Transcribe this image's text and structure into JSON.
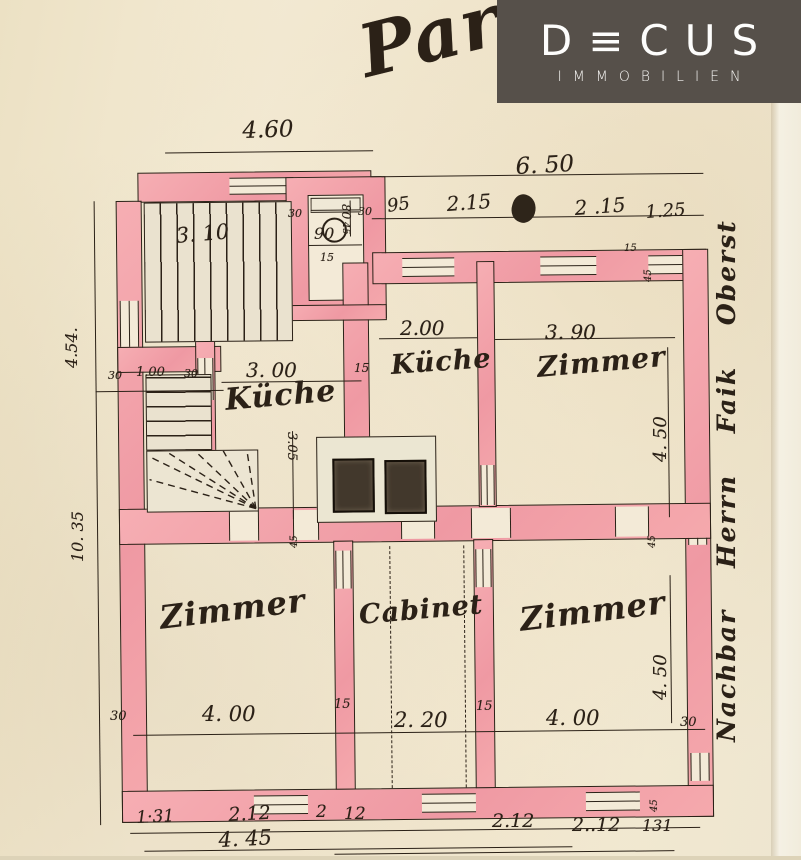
{
  "logo": {
    "brand": "DECUS",
    "wordmark": "D≡CUS",
    "subtitle": "IMMOBILIEN",
    "bg_color": "#56504a",
    "text_color": "#fdfdfc"
  },
  "plan": {
    "title_script": "Par",
    "side_note": "Nachbar Herrn Faik Oberst",
    "room_labels": [
      "Küche",
      "Küche",
      "Zimmer",
      "Zimmer",
      "Cabinet",
      "Zimmer"
    ],
    "colors": {
      "paper": "#f3e9d1",
      "wall_pink": "#f2a2a8",
      "ink": "#2b2117",
      "stove": "#42382c"
    },
    "annotations": [
      {
        "name": "plan-title",
        "text": "Par",
        "x": 352,
        "y": 18,
        "fs": 72,
        "rot": -14,
        "cls": "script title"
      },
      {
        "name": "dim-label",
        "text": "4.60",
        "x": 242,
        "y": 120,
        "fs": 23,
        "rot": -2
      },
      {
        "name": "dim-label",
        "text": "6. 50",
        "x": 515,
        "y": 156,
        "fs": 23,
        "rot": -3
      },
      {
        "name": "dim-label",
        "text": "95",
        "x": 386,
        "y": 198,
        "fs": 18,
        "rot": -8
      },
      {
        "name": "dim-label",
        "text": "2.15",
        "x": 446,
        "y": 194,
        "fs": 20,
        "rot": -4
      },
      {
        "name": "dim-label",
        "text": "2 .15",
        "x": 574,
        "y": 198,
        "fs": 20,
        "rot": -4
      },
      {
        "name": "dim-label",
        "text": "1.25",
        "x": 645,
        "y": 204,
        "fs": 18,
        "rot": -4
      },
      {
        "name": "dim-label",
        "text": "3. 10",
        "x": 175,
        "y": 226,
        "fs": 21,
        "rot": -5
      },
      {
        "name": "dim-label",
        "text": "80",
        "x": 352,
        "y": 204,
        "fs": 12,
        "rot": 90
      },
      {
        "name": "dim-label",
        "text": "30",
        "x": 288,
        "y": 208,
        "fs": 11
      },
      {
        "name": "dim-label",
        "text": "30",
        "x": 358,
        "y": 206,
        "fs": 11
      },
      {
        "name": "dim-label",
        "text": "90",
        "x": 314,
        "y": 226,
        "fs": 16
      },
      {
        "name": "dim-label",
        "text": "45",
        "x": 350,
        "y": 222,
        "fs": 10,
        "rot": 90
      },
      {
        "name": "dim-label",
        "text": "15",
        "x": 320,
        "y": 252,
        "fs": 11
      },
      {
        "name": "dim-label",
        "text": "4.54.",
        "x": 64,
        "y": 368,
        "fs": 16,
        "rot": -90
      },
      {
        "name": "dim-label",
        "text": "10. 35",
        "x": 70,
        "y": 562,
        "fs": 16,
        "rot": -90
      },
      {
        "name": "dim-label",
        "text": "30",
        "x": 108,
        "y": 370,
        "fs": 11
      },
      {
        "name": "dim-label",
        "text": "1.00",
        "x": 136,
        "y": 366,
        "fs": 13
      },
      {
        "name": "dim-label",
        "text": "30",
        "x": 184,
        "y": 368,
        "fs": 11
      },
      {
        "name": "dim-label",
        "text": "3. 00",
        "x": 246,
        "y": 360,
        "fs": 20
      },
      {
        "name": "dim-label",
        "text": "15",
        "x": 354,
        "y": 362,
        "fs": 12
      },
      {
        "name": "dim-label",
        "text": "2.00",
        "x": 400,
        "y": 318,
        "fs": 20
      },
      {
        "name": "dim-label",
        "text": "3. 90",
        "x": 545,
        "y": 322,
        "fs": 20
      },
      {
        "name": "dim-label",
        "text": "15",
        "x": 624,
        "y": 244,
        "fs": 10
      },
      {
        "name": "dim-label",
        "text": "45",
        "x": 644,
        "y": 282,
        "fs": 10,
        "rot": -90
      },
      {
        "name": "dim-label",
        "text": "4. 50",
        "x": 652,
        "y": 462,
        "fs": 18,
        "rot": -90
      },
      {
        "name": "dim-label",
        "text": "45",
        "x": 648,
        "y": 548,
        "fs": 10,
        "rot": -90
      },
      {
        "name": "dim-label",
        "text": "3.05",
        "x": 298,
        "y": 432,
        "fs": 13,
        "rot": 90
      },
      {
        "name": "dim-label",
        "text": "45",
        "x": 290,
        "y": 548,
        "fs": 10,
        "rot": -90
      },
      {
        "name": "room-label",
        "text": "Küche",
        "x": 224,
        "y": 386,
        "fs": 30,
        "rot": -5,
        "cls": "script"
      },
      {
        "name": "room-label",
        "text": "Küche",
        "x": 390,
        "y": 352,
        "fs": 27,
        "rot": -4,
        "cls": "script"
      },
      {
        "name": "room-label",
        "text": "Zimmer",
        "x": 536,
        "y": 354,
        "fs": 28,
        "rot": -5,
        "cls": "script"
      },
      {
        "name": "room-label",
        "text": "Zimmer",
        "x": 158,
        "y": 602,
        "fs": 32,
        "rot": -7,
        "cls": "script"
      },
      {
        "name": "room-label",
        "text": "Cabinet",
        "x": 358,
        "y": 602,
        "fs": 27,
        "rot": -5,
        "cls": "script"
      },
      {
        "name": "room-label",
        "text": "Zimmer",
        "x": 518,
        "y": 604,
        "fs": 32,
        "rot": -7,
        "cls": "script"
      },
      {
        "name": "dim-label",
        "text": "30",
        "x": 110,
        "y": 710,
        "fs": 13
      },
      {
        "name": "dim-label",
        "text": "4. 00",
        "x": 202,
        "y": 704,
        "fs": 21
      },
      {
        "name": "dim-label",
        "text": "15",
        "x": 334,
        "y": 698,
        "fs": 13
      },
      {
        "name": "dim-label",
        "text": "2. 20",
        "x": 394,
        "y": 710,
        "fs": 21
      },
      {
        "name": "dim-label",
        "text": "15",
        "x": 476,
        "y": 700,
        "fs": 13
      },
      {
        "name": "dim-label",
        "text": "4. 00",
        "x": 546,
        "y": 708,
        "fs": 21
      },
      {
        "name": "dim-label",
        "text": "30",
        "x": 680,
        "y": 716,
        "fs": 13
      },
      {
        "name": "dim-label",
        "text": "4. 50",
        "x": 652,
        "y": 700,
        "fs": 18,
        "rot": -90
      },
      {
        "name": "dim-label",
        "text": "45",
        "x": 650,
        "y": 812,
        "fs": 10,
        "rot": -90
      },
      {
        "name": "dim-label",
        "text": "1·31",
        "x": 136,
        "y": 810,
        "fs": 17,
        "rot": -3
      },
      {
        "name": "dim-label",
        "text": "2.12",
        "x": 228,
        "y": 806,
        "fs": 19,
        "rot": -3
      },
      {
        "name": "dim-label",
        "text": "2",
        "x": 316,
        "y": 804,
        "fs": 17
      },
      {
        "name": "dim-label",
        "text": "12",
        "x": 344,
        "y": 806,
        "fs": 17
      },
      {
        "name": "dim-label",
        "text": "2.12",
        "x": 492,
        "y": 812,
        "fs": 19
      },
      {
        "name": "dim-label",
        "text": "2..12",
        "x": 572,
        "y": 816,
        "fs": 19
      },
      {
        "name": "dim-label",
        "text": "131",
        "x": 642,
        "y": 818,
        "fs": 16
      },
      {
        "name": "dim-label",
        "text": "4. 45",
        "x": 218,
        "y": 830,
        "fs": 21,
        "rot": -3
      },
      {
        "name": "side-note",
        "text": "Nachbar Herrn Faik Oberst",
        "x": 714,
        "y": 742,
        "fs": 25,
        "rot": -90,
        "cls": "script side"
      }
    ]
  }
}
